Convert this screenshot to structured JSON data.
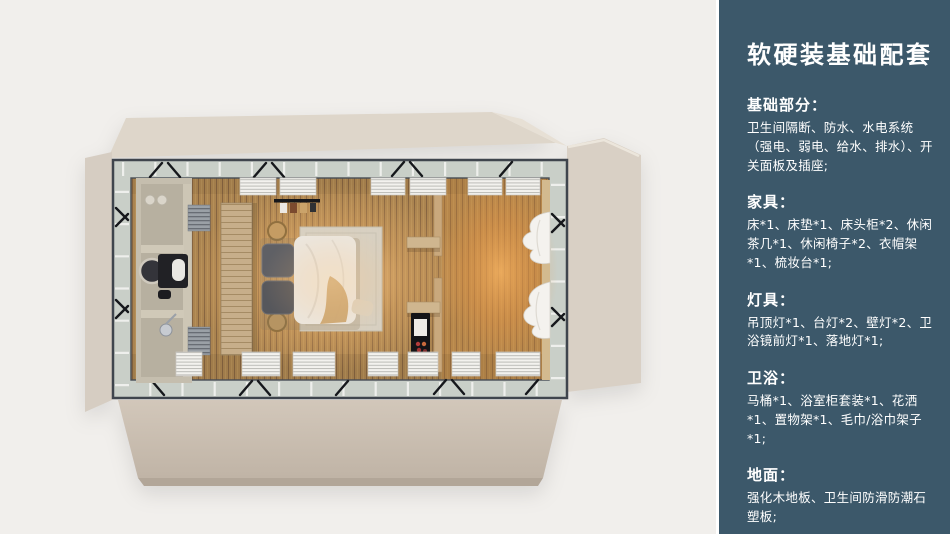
{
  "sidebar": {
    "title": "软硬装基础配套",
    "sections": [
      {
        "heading": "基础部分：",
        "body": "卫生间隔断、防水、水电系统（强电、弱电、给水、排水）、开关面板及插座;"
      },
      {
        "heading": "家具：",
        "body": "床*1、床垫*1、床头柜*2、休闲茶几*1、休闲椅子*2、衣帽架*1、梳妆台*1;"
      },
      {
        "heading": "灯具：",
        "body": "吊顶灯*1、台灯*2、壁灯*2、卫浴镜前灯*1、落地灯*1;"
      },
      {
        "heading": "卫浴：",
        "body": "马桶*1、浴室柜套装*1、花洒*1、置物架*1、毛巾/浴巾架子*1;"
      },
      {
        "heading": "地面：",
        "body": "强化木地板、卫生间防滑防潮石塑板;"
      }
    ]
  },
  "colors": {
    "canvas_bg": "#f1efec",
    "sidebar_bg": "#3c586a",
    "sidebar_text": "#ffffff",
    "divider": "#ffffff",
    "frame_steel": "#3f454d",
    "glass": "#c9cfc8",
    "floor_wood": "#aa8451",
    "glow_warm": "#ffb469",
    "shell_beige": "#d8cfc4"
  }
}
